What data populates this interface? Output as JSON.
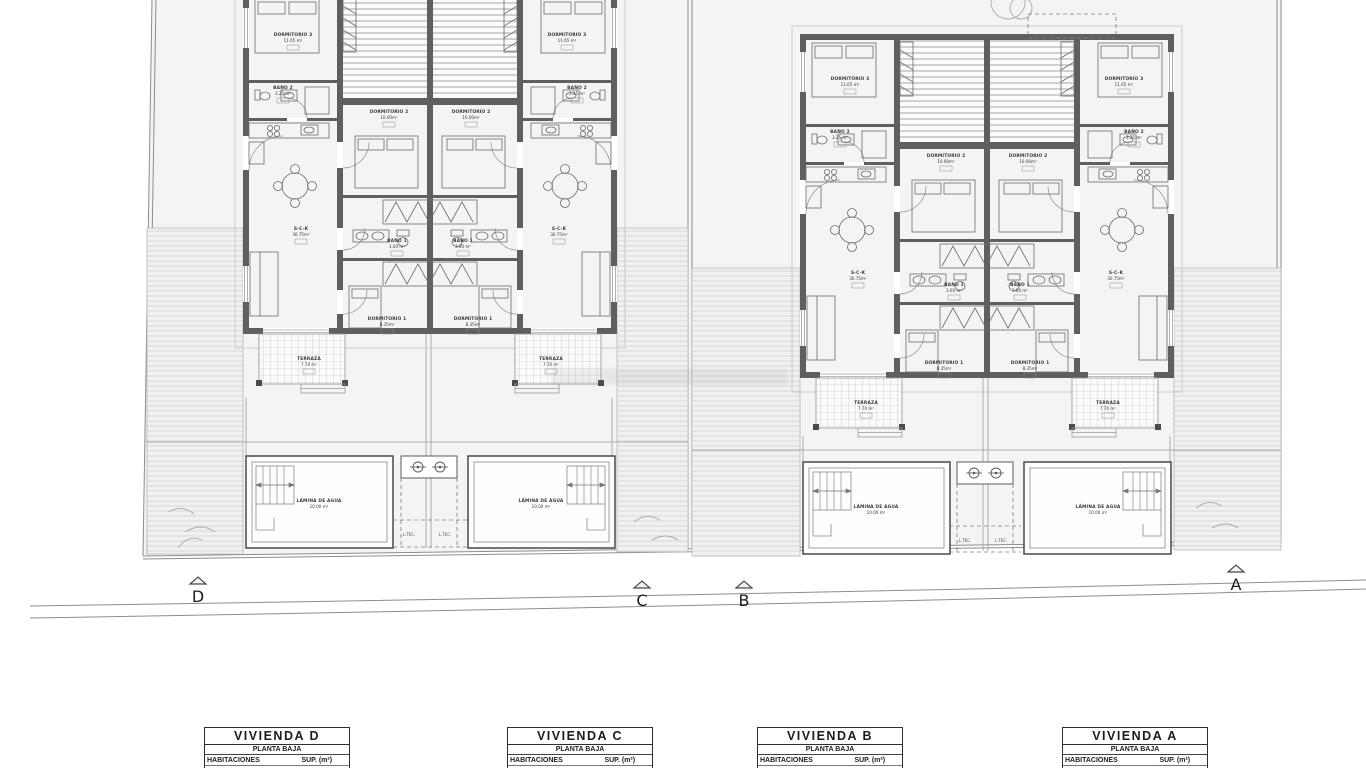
{
  "site": {
    "ltec_label": "L.TEC.",
    "markers": [
      {
        "letter": "D"
      },
      {
        "letter": "C"
      },
      {
        "letter": "B"
      },
      {
        "letter": "A"
      }
    ]
  },
  "units": [
    {
      "id": "D",
      "rooms": [
        {
          "label": "DORMITORIO 3",
          "area": "11.65 m²"
        },
        {
          "label": "BAÑO 2",
          "area": "3.25 m²"
        },
        {
          "label": "DORMITORIO 2",
          "area": "10.00m²"
        },
        {
          "label": "S-C-K",
          "area": "30.75m²"
        },
        {
          "label": "BAÑO 1",
          "area": "3.60 m²"
        },
        {
          "label": "DORMITORIO 1",
          "area": "8.35m²"
        },
        {
          "label": "TERRAZA",
          "area": "7.70 m²"
        }
      ],
      "pool": {
        "label": "LÁMINA DE AGUA",
        "area": "10.00 m²"
      }
    },
    {
      "id": "C",
      "rooms": [
        {
          "label": "DORMITORIO 3",
          "area": "11.65 m²"
        },
        {
          "label": "BAÑO 2",
          "area": "3.25 m²"
        },
        {
          "label": "DORMITORIO 2",
          "area": "10.00m²"
        },
        {
          "label": "S-C-K",
          "area": "30.75m²"
        },
        {
          "label": "BAÑO 1",
          "area": "3.60 m²"
        },
        {
          "label": "DORMITORIO 1",
          "area": "8.35m²"
        },
        {
          "label": "TERRAZA",
          "area": "7.70 m²"
        }
      ],
      "pool": {
        "label": "LÁMINA DE AGUA",
        "area": "10.00 m²"
      }
    },
    {
      "id": "B",
      "rooms": [
        {
          "label": "DORMITORIO 3",
          "area": "11.65 m²"
        },
        {
          "label": "BAÑO 2",
          "area": "3.25 m²"
        },
        {
          "label": "DORMITORIO 2",
          "area": "10.00m²"
        },
        {
          "label": "S-C-K",
          "area": "30.75m²"
        },
        {
          "label": "BAÑO 1",
          "area": "3.60 m²"
        },
        {
          "label": "DORMITORIO 1",
          "area": "8.35m²"
        },
        {
          "label": "TERRAZA",
          "area": "7.70 m²"
        }
      ],
      "pool": {
        "label": "LÁMINA DE AGUA",
        "area": "10.00 m²"
      }
    },
    {
      "id": "A",
      "rooms": [
        {
          "label": "DORMITORIO 3",
          "area": "11.65 m²"
        },
        {
          "label": "BAÑO 2",
          "area": "3.25 m²"
        },
        {
          "label": "DORMITORIO 2",
          "area": "10.00m²"
        },
        {
          "label": "S-C-K",
          "area": "30.75m²"
        },
        {
          "label": "BAÑO 1",
          "area": "3.60 m²"
        },
        {
          "label": "DORMITORIO 1",
          "area": "8.35m²"
        },
        {
          "label": "TERRAZA",
          "area": "7.70 m²"
        }
      ],
      "pool": {
        "label": "LÁMINA DE AGUA",
        "area": "10.00 m²"
      }
    }
  ],
  "tables": [
    {
      "title": "VIVIENDA D",
      "subtitle": "PLANTA BAJA",
      "col1": "HABITACIONES",
      "col2": "SUP. (m²)",
      "rows": [
        [
          "Salón-comedor-cocina",
          "30.75"
        ]
      ]
    },
    {
      "title": "VIVIENDA C",
      "subtitle": "PLANTA BAJA",
      "col1": "HABITACIONES",
      "col2": "SUP. (m²)",
      "rows": [
        [
          "Salón-comedor-cocina",
          "30.75"
        ]
      ]
    },
    {
      "title": "VIVIENDA B",
      "subtitle": "PLANTA BAJA",
      "col1": "HABITACIONES",
      "col2": "SUP. (m²)",
      "rows": [
        [
          "Salón-comedor-cocina",
          "30.75"
        ]
      ]
    },
    {
      "title": "VIVIENDA A",
      "subtitle": "PLANTA BAJA",
      "col1": "HABITACIONES",
      "col2": "SUP. (m²)",
      "rows": [
        [
          "Salón-comedor-cocina",
          "30.75"
        ]
      ]
    }
  ]
}
